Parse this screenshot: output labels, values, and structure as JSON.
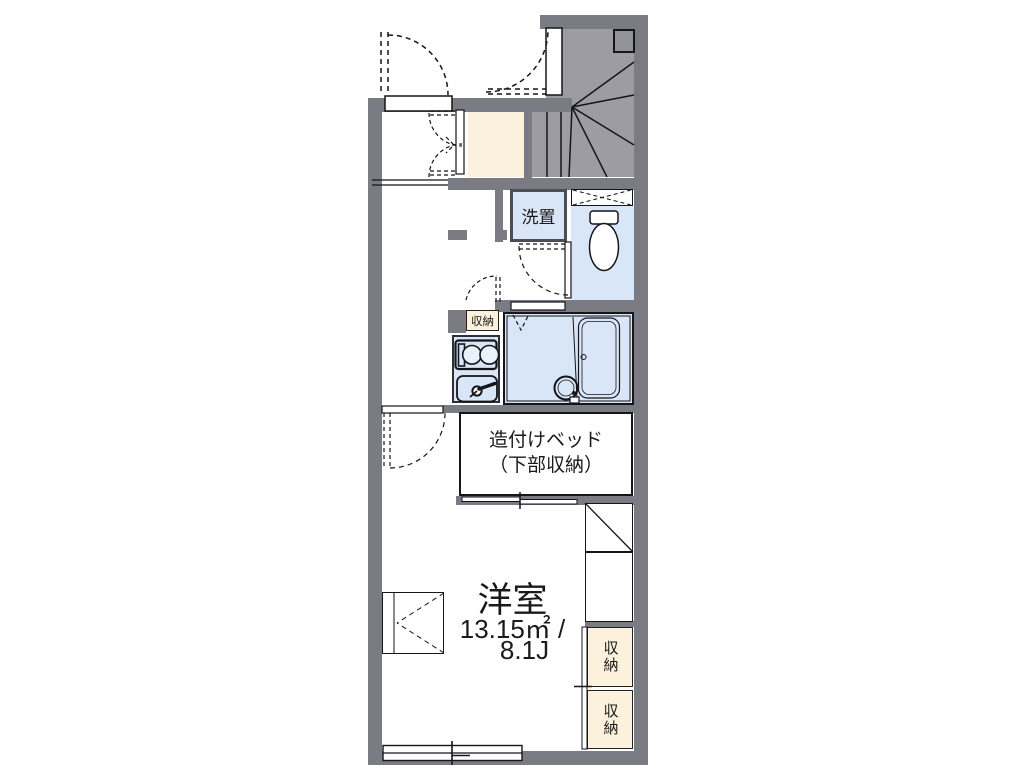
{
  "floorplan": {
    "washer": {
      "label": "洗置"
    },
    "kitchen_storage": {
      "label": "収納"
    },
    "bed": {
      "line1": "造付けベッド",
      "line2": "（下部収納）"
    },
    "main_room": {
      "name": "洋室",
      "area_sqm": "13.15㎡ /",
      "area_jo": "8.1J"
    },
    "right_storage": [
      {
        "label": "収納"
      },
      {
        "label": "収納"
      }
    ],
    "colors": {
      "wall": "#7b7b84",
      "stair_fill": "#9c9ca2",
      "water_fixture_fill": "#d9e6f7",
      "storage_fill": "#fbf1dc",
      "line": "#15151a"
    }
  }
}
